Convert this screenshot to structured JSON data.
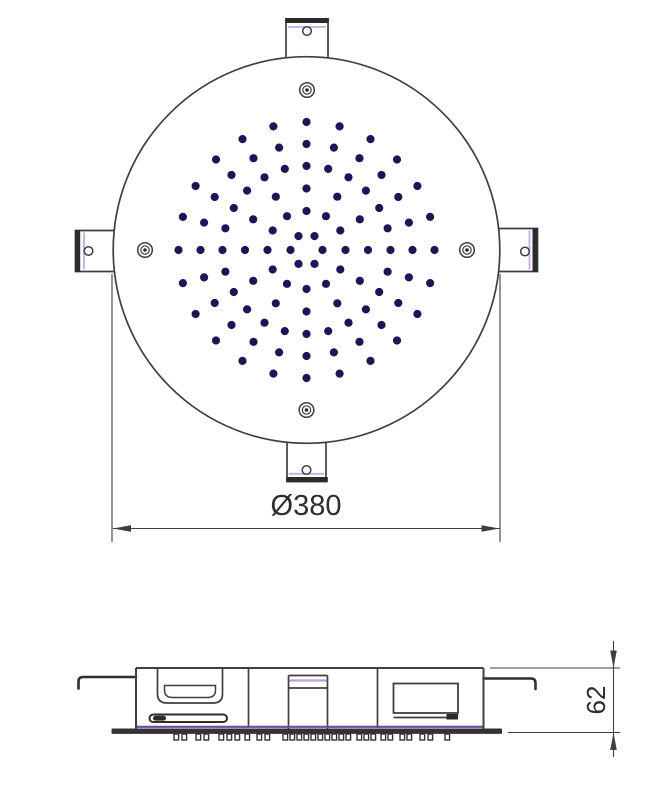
{
  "labels": {
    "diameter_dimension": "Ø380",
    "height_dimension": "62"
  },
  "colors": {
    "line": "#3f3f3f",
    "dark_fill": "#2b2b2b",
    "accent_lavender": "#c5abe4",
    "accent_purple": "#b9a0e2",
    "flange_purple": "#6a48a2",
    "nozzle_dot": "#241257",
    "text": "#2d2d2d",
    "background": "#ffffff"
  },
  "top_view": {
    "center": {
      "x": 306.5,
      "y": 250
    },
    "plate_radius": 193.3,
    "mounting_tab_count": 4,
    "screw_hole_count": 4,
    "nozzle_dot_radius": 4.1,
    "nozzle_rings": [
      {
        "radius": 16,
        "count": 6,
        "offset_deg": 0
      },
      {
        "radius": 39,
        "count": 12,
        "offset_deg": 0
      },
      {
        "radius": 61.5,
        "count": 12,
        "offset_deg": 0
      },
      {
        "radius": 84,
        "count": 24,
        "offset_deg": 0
      },
      {
        "radius": 106,
        "count": 24,
        "offset_deg": 0
      },
      {
        "radius": 128,
        "count": 24,
        "offset_deg": 0
      }
    ]
  },
  "side_view": {
    "teeth": {
      "y": 734,
      "width": 4.6,
      "height": 6,
      "x_positions": [
        174,
        182,
        196,
        204,
        219,
        227,
        235,
        245,
        257,
        265,
        283,
        290,
        297,
        304,
        311,
        318,
        325,
        332,
        339,
        346,
        357,
        364,
        371,
        381,
        388,
        400,
        407,
        420,
        428,
        445
      ]
    }
  }
}
